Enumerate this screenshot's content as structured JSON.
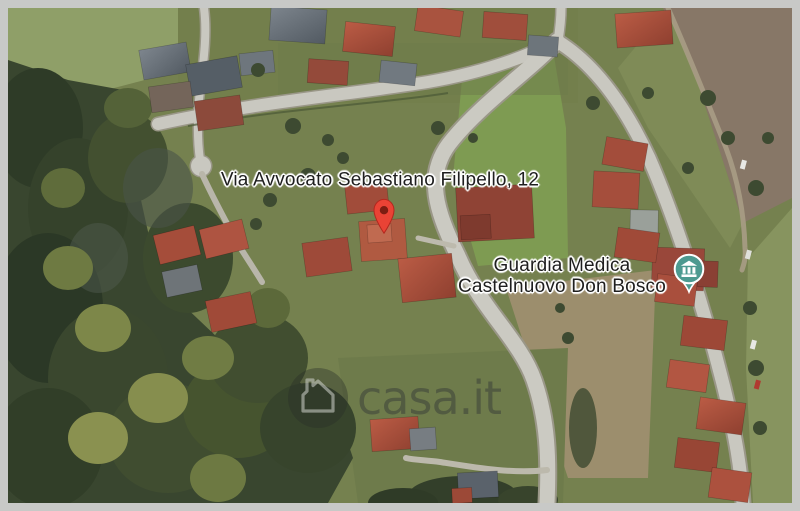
{
  "window": {
    "kind": "satellite-map-screenshot",
    "border_color": "#c8c9c7"
  },
  "map": {
    "type": "satellite",
    "address_label": "Via Avvocato Sebastiano Filipello, 12",
    "destination_pin": {
      "icon": "map-pin",
      "color": "#ea4335",
      "inner_dot_color": "#7d1d12"
    },
    "poi": {
      "name_line1": "Guardia Medica",
      "name_line2": "Castelnuovo Don Bosco",
      "icon": "civic-building-pin",
      "pin_color": "#4d9a90"
    },
    "watermark": {
      "text": "casa.it",
      "icon": "house-outline"
    },
    "label_text_color": "#1e1e1e"
  }
}
